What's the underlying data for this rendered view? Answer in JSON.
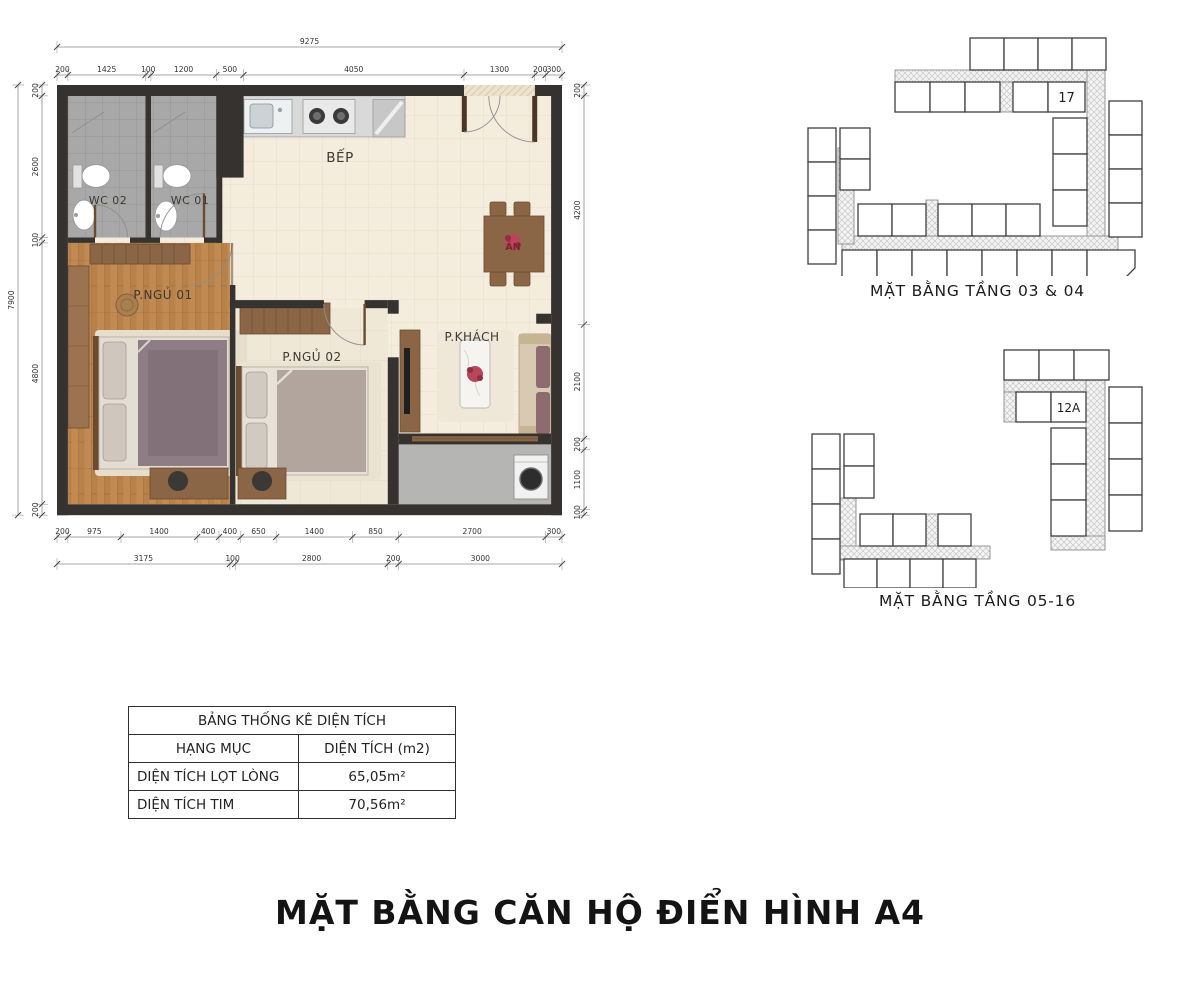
{
  "title": "MẶT BẰNG CĂN HỘ ĐIỂN HÌNH A4",
  "colors": {
    "accent_orange": "#E8973B"
  },
  "floor_plan": {
    "rooms": {
      "kitchen": "BẾP",
      "wc1": "WC 01",
      "wc2": "WC 02",
      "bedroom1": "P.NGỦ 01",
      "bedroom2": "P.NGỦ 02",
      "living": "P.KHÁCH",
      "dining": "ĂN"
    },
    "dimensions": {
      "top_total": [
        "9275"
      ],
      "top_segments": [
        "200",
        "1425",
        "100",
        "1200",
        "500",
        "4050",
        "1300",
        "200",
        "300"
      ],
      "left_total": [
        "7900"
      ],
      "left_segments": [
        "200",
        "2600",
        "100",
        "4800",
        "200"
      ],
      "right_segments": [
        "200",
        "4200",
        "2100",
        "200",
        "1100",
        "100"
      ],
      "bottom_segments": [
        "200",
        "975",
        "1400",
        "400",
        "400",
        "650",
        "1400",
        "850",
        "2700",
        "300"
      ],
      "bottom_totals": [
        "3175",
        "100",
        "2800",
        "200",
        "3000"
      ]
    }
  },
  "key_plans": [
    {
      "caption": "MẶT BẰNG TẦNG 03 & 04",
      "highlighted_unit": "17"
    },
    {
      "caption": "MẶT BẰNG TẦNG 05-16",
      "highlighted_unit": "12A"
    }
  ],
  "area_table": {
    "title": "BẢNG THỐNG KÊ DIỆN TÍCH",
    "col_item": "HẠNG MỤC",
    "col_area": "DIỆN TÍCH (m2)",
    "rows": [
      {
        "label": "DIỆN TÍCH LỌT LÒNG",
        "value": "65,05m²"
      },
      {
        "label": "DIỆN TÍCH TIM",
        "value": "70,56m²"
      }
    ]
  }
}
